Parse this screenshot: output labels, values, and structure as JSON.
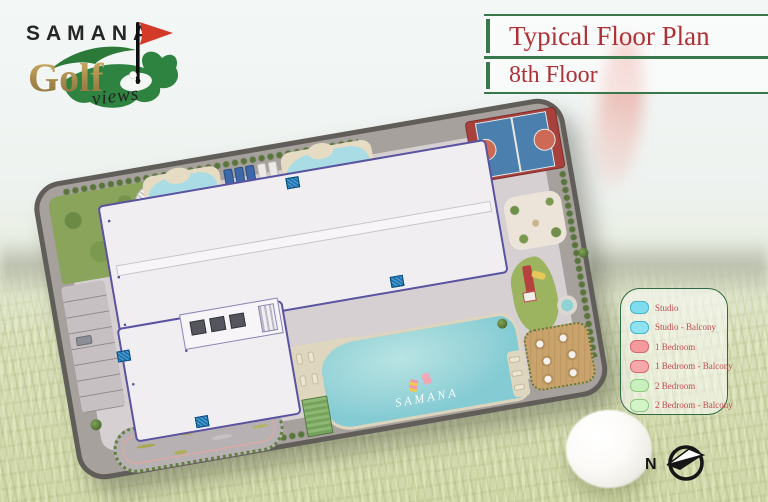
{
  "logo": {
    "brand": "SAMANA",
    "word": "Golf",
    "script": "views"
  },
  "header": {
    "title": "Typical Floor Plan",
    "subtitle": "8th Floor"
  },
  "legend": {
    "items": [
      {
        "label": "Studio",
        "fill": "#7fdcec",
        "stroke": "#45b5cc"
      },
      {
        "label": "Studio - Balcony",
        "fill": "#8fe2ef",
        "stroke": "#45b5cc"
      },
      {
        "label": "1 Bedroom",
        "fill": "#f49a9e",
        "stroke": "#d66a70"
      },
      {
        "label": "1 Bedroom - Balcony",
        "fill": "#f6a8ab",
        "stroke": "#d66a70"
      },
      {
        "label": "2 Bedroom",
        "fill": "#c8efbc",
        "stroke": "#8cc981"
      },
      {
        "label": "2 Bedroom - Balcony",
        "fill": "#d2f4c6",
        "stroke": "#8cc981"
      }
    ]
  },
  "floor_plan": {
    "watermark": "SAMANA",
    "unit_colors": {
      "cyan": "#a5e3ef",
      "pink": "#f6aeb1",
      "green": "#cdf0c2",
      "core": "#f7f5f7"
    },
    "rows": {
      "north": [
        "green",
        "pink",
        "pink",
        "cyan",
        "cyan",
        "cyan",
        "cyan",
        "cyan",
        "core",
        "cyan",
        "cyan",
        "pink",
        "pink",
        "green"
      ],
      "south": [
        "green",
        "cyan",
        "cyan",
        "pink",
        "pink",
        "cyan",
        "cyan",
        "cyan",
        "pink",
        "pink",
        "cyan",
        "green"
      ],
      "wing_west": [
        "cyan",
        "cyan",
        "cyan"
      ],
      "wing_inner": [
        "cyan",
        "cyan"
      ],
      "wing_south": [
        "green",
        "green",
        "green",
        "green"
      ]
    },
    "pool_strips": {
      "north": 8,
      "south": 5,
      "wing_west": 2,
      "wing_south": 3
    }
  },
  "compass": {
    "label": "N"
  },
  "colors": {
    "title_red": "#ad3136",
    "line_green": "#38784a",
    "legend_text": "#c04a4e"
  }
}
